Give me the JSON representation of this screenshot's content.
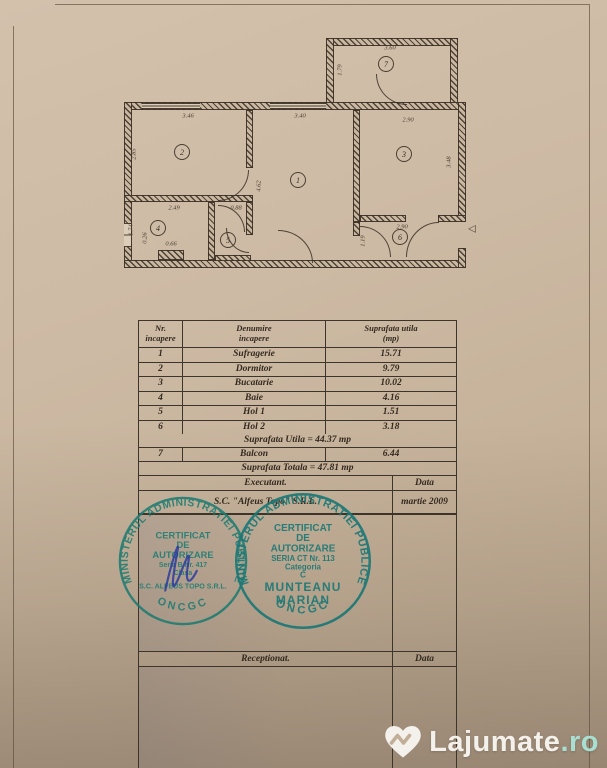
{
  "page": {
    "paper_color": "#cdbaa4",
    "line_color": "#4a3e31",
    "stamp_ink": "#1e7b72",
    "signature_ink": "#2c3c9e"
  },
  "floorplan": {
    "rooms": [
      {
        "n": "1",
        "x": 180,
        "y": 150
      },
      {
        "n": "2",
        "x": 64,
        "y": 122
      },
      {
        "n": "3",
        "x": 286,
        "y": 124
      },
      {
        "n": "4",
        "x": 40,
        "y": 198
      },
      {
        "n": "5",
        "x": 110,
        "y": 210
      },
      {
        "n": "6",
        "x": 282,
        "y": 207
      },
      {
        "n": "7",
        "x": 268,
        "y": 34
      }
    ],
    "dims": [
      {
        "t": "3.46",
        "x": 70,
        "y": 86,
        "v": false
      },
      {
        "t": "3.40",
        "x": 182,
        "y": 86,
        "v": false
      },
      {
        "t": "2.90",
        "x": 290,
        "y": 90,
        "v": false
      },
      {
        "t": "3.60",
        "x": 272,
        "y": 18,
        "v": false
      },
      {
        "t": "1.79",
        "x": 222,
        "y": 40,
        "v": true
      },
      {
        "t": "2.85",
        "x": 16,
        "y": 124,
        "v": true
      },
      {
        "t": "4.62",
        "x": 141,
        "y": 156,
        "v": true
      },
      {
        "t": "3.48",
        "x": 331,
        "y": 132,
        "v": true
      },
      {
        "t": "2.49",
        "x": 56,
        "y": 178,
        "v": false
      },
      {
        "t": "1.74",
        "x": 13,
        "y": 200,
        "v": true
      },
      {
        "t": "0.26",
        "x": 27,
        "y": 208,
        "v": true
      },
      {
        "t": "0.66",
        "x": 53,
        "y": 214,
        "v": false
      },
      {
        "t": "0.88",
        "x": 118,
        "y": 178,
        "v": false
      },
      {
        "t": "2.90",
        "x": 284,
        "y": 197,
        "v": false
      },
      {
        "t": "1.19",
        "x": 245,
        "y": 211,
        "v": true
      }
    ],
    "entrance_arrow": "◁"
  },
  "table": {
    "headers": {
      "nr": "Nr.\nincapere",
      "denumire": "Denumire\nincapere",
      "suprafata": "Suprafata utila\n(mp)"
    },
    "rows": [
      {
        "nr": "1",
        "name": "Sufragerie",
        "area": "15.71"
      },
      {
        "nr": "2",
        "name": "Dormitor",
        "area": "9.79"
      },
      {
        "nr": "3",
        "name": "Bucatarie",
        "area": "10.02"
      },
      {
        "nr": "4",
        "name": "Baie",
        "area": "4.16"
      },
      {
        "nr": "5",
        "name": "Hol 1",
        "area": "1.51"
      },
      {
        "nr": "6",
        "name": "Hol 2",
        "area": "3.18"
      }
    ],
    "suprafata_utila": "Suprafata Utila = 44.37 mp",
    "balcon_row": {
      "nr": "7",
      "name": "Balcon",
      "area": "6.44"
    },
    "suprafata_totala": "Suprafata Totala = 47.81 mp",
    "executant_label": "Executant.",
    "data_label": "Data",
    "executant_value": "S.C. \"Alfeus Topo\" S.R.L.",
    "data_value": "martie 2009",
    "receptionat_label": "Receptionat.",
    "data_label2": "Data"
  },
  "stamps": {
    "left": {
      "ring_top": "MINISTERUL ADMINISTRATIEI PUBLICE",
      "ring_bottom": "ONCGC",
      "lines": [
        "CERTIFICAT",
        "DE",
        "AUTORIZARE",
        "Seria B Nr. 417",
        "Clasa",
        "S.C. ALFEUS TOPO S.R.L."
      ]
    },
    "right": {
      "ring_top": "MINISTERUL ADMINISTRATIEI PUBLICE",
      "ring_bottom": "ONCGC",
      "lines": [
        "CERTIFICAT",
        "DE",
        "AUTORIZARE",
        "SERIA CT Nr. 113",
        "Categoria",
        "C",
        "MUNTEANU",
        "MARIAN"
      ]
    }
  },
  "watermark": {
    "name": "Lajumate",
    "suffix": ".ro"
  }
}
